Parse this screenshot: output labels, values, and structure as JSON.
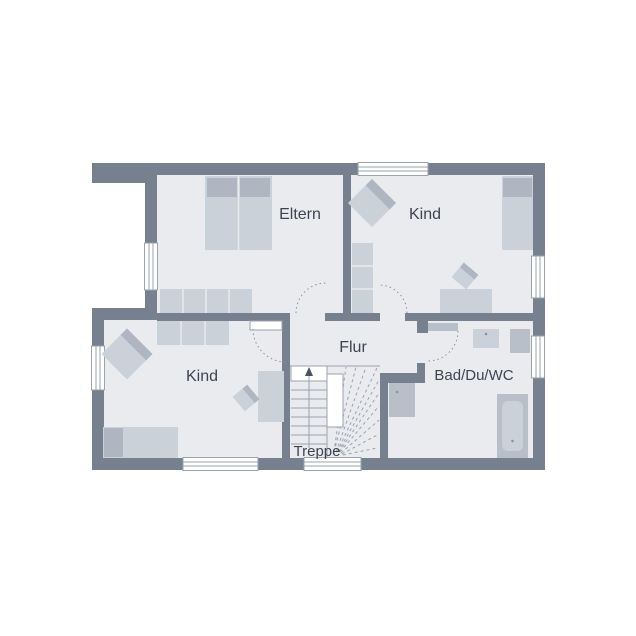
{
  "plan": {
    "title": "floor-plan-upper-storey",
    "rooms": {
      "eltern": {
        "label": "Eltern"
      },
      "kind_top": {
        "label": "Kind"
      },
      "kind_bottom": {
        "label": "Kind"
      },
      "flur": {
        "label": "Flur"
      },
      "bad": {
        "label": "Bad/Du/WC"
      },
      "treppe": {
        "label": "Treppe"
      }
    },
    "furniture": {
      "eltern": [
        "double-bed",
        "wardrobe-4"
      ],
      "kind_top": [
        "armchair",
        "shelf-3",
        "bed",
        "desk",
        "desk-chair"
      ],
      "kind_bottom": [
        "armchair",
        "wardrobe-3",
        "bed",
        "desk",
        "desk-chair"
      ],
      "bad": [
        "washbasin",
        "wc",
        "shower",
        "bathtub"
      ],
      "treppe": [
        "winding-staircase",
        "up-arrow"
      ]
    },
    "colors": {
      "wall": "#76808F",
      "floor": "#E9EBEF",
      "furniture": "#CBD1D9",
      "furniture_dark": "#AFB6C1",
      "fixture": "#B9BFC9",
      "line": "#9AA3AF",
      "door_arc": "#8A93A0",
      "text": "#3E4450",
      "background": "#FFFFFF"
    }
  }
}
